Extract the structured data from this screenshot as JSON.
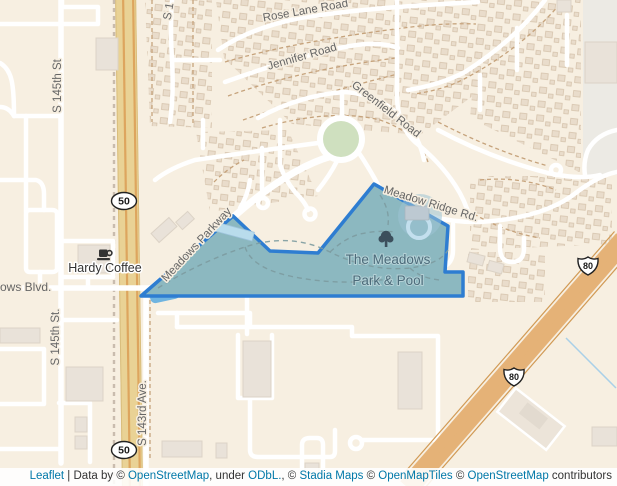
{
  "colors": {
    "base": "#f7efe1",
    "road": "#ffffff",
    "label": "#666666",
    "park_fill": "#8cb8c0",
    "park_outline": "#2e7dd1",
    "park_label": "#4c6b7a",
    "water": "#6fb4e0",
    "highway_band": "#e9d295",
    "highway_stripe": "#dda55e",
    "motorway_band": "#e5b277",
    "attribution_link": "#0078A8",
    "shield_outline": "#222222"
  },
  "map": {
    "street_labels": {
      "rose_lane_road": "Rose Lane Road",
      "jennifer_road": "Jennifer Road",
      "greenfield_road": "Greenfield Road",
      "meadow_ridge_rd": "Meadow Ridge Rd.",
      "meadows_parkway": "Meadows Parkway",
      "meadows_blvd_partial": "ows Blvd.",
      "s_145th_st_north": "S 145th St",
      "s_145th_st_south": "S 145th St.",
      "s_143rd_ave": "S 143rd Ave.",
      "s_1_partial": "S 1"
    },
    "poi": {
      "hardy_coffee": "Hardy Coffee"
    },
    "park": {
      "title_line1": "The Meadows",
      "title_line2": "Park & Pool"
    },
    "route_shields": {
      "us_route_50": "50",
      "interstate_80": "80"
    },
    "icons": [
      "tree-icon",
      "coffee-cup-icon"
    ]
  },
  "attribution": {
    "items": [
      {
        "text": "Leaflet",
        "link": true
      },
      {
        "text": " | Data by © ",
        "link": false
      },
      {
        "text": "OpenStreetMap",
        "link": true
      },
      {
        "text": ", under ",
        "link": false
      },
      {
        "text": "ODbL.",
        "link": true
      },
      {
        "text": ", © ",
        "link": false
      },
      {
        "text": "Stadia Maps",
        "link": true
      },
      {
        "text": " © ",
        "link": false
      },
      {
        "text": "OpenMapTiles",
        "link": true
      },
      {
        "text": " © ",
        "link": false
      },
      {
        "text": "OpenStreetMap",
        "link": true
      },
      {
        "text": " contributors",
        "link": false
      }
    ]
  }
}
